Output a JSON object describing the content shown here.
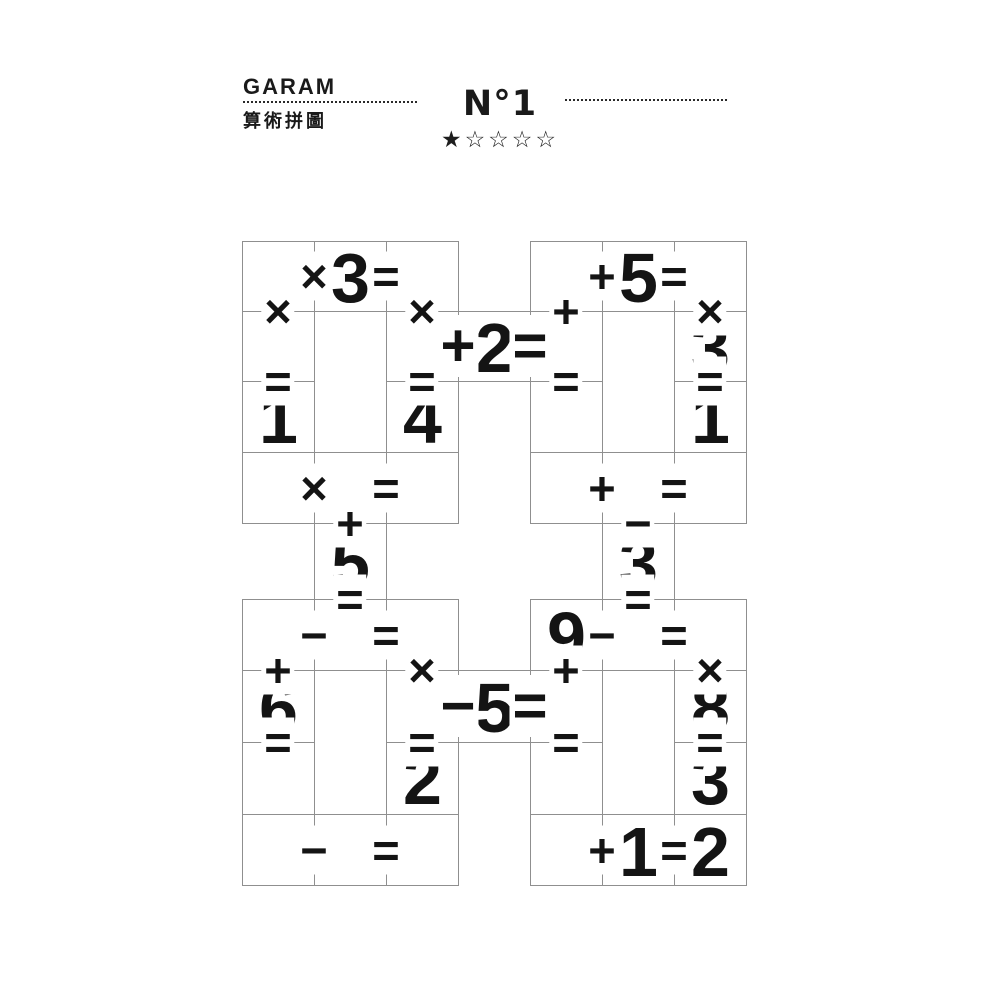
{
  "header": {
    "brand": "GARAM",
    "subtitle": "算術拼圖",
    "puzzle_number": "N°1",
    "stars": {
      "filled": "★",
      "empty": "☆☆☆☆"
    }
  },
  "colors": {
    "ink": "#161616",
    "grid_line": "#8f8f8f",
    "background": "#ffffff"
  },
  "puzzle": {
    "cols_x": [
      242,
      314,
      386,
      458,
      530,
      602,
      674,
      746
    ],
    "rows_y": [
      241,
      311,
      381,
      452,
      523,
      599,
      670,
      742,
      814,
      885
    ],
    "cells": [
      {
        "r": 0,
        "c": 0,
        "v": ""
      },
      {
        "r": 0,
        "c": 1,
        "v": "3"
      },
      {
        "r": 0,
        "c": 2,
        "v": ""
      },
      {
        "r": 1,
        "c": 0,
        "v": ""
      },
      {
        "r": 1,
        "c": 1,
        "rs": 2,
        "v": ""
      },
      {
        "r": 1,
        "c": 2,
        "v": ""
      },
      {
        "r": 2,
        "c": 0,
        "v": "1"
      },
      {
        "r": 2,
        "c": 2,
        "v": "4"
      },
      {
        "r": 3,
        "c": 0,
        "v": ""
      },
      {
        "r": 3,
        "c": 1,
        "v": ""
      },
      {
        "r": 3,
        "c": 2,
        "v": ""
      },
      {
        "r": 0,
        "c": 4,
        "v": ""
      },
      {
        "r": 0,
        "c": 5,
        "v": "5"
      },
      {
        "r": 0,
        "c": 6,
        "v": ""
      },
      {
        "r": 1,
        "c": 4,
        "v": ""
      },
      {
        "r": 1,
        "c": 5,
        "rs": 2,
        "v": ""
      },
      {
        "r": 1,
        "c": 6,
        "v": "3"
      },
      {
        "r": 2,
        "c": 4,
        "v": ""
      },
      {
        "r": 2,
        "c": 6,
        "v": "1"
      },
      {
        "r": 3,
        "c": 4,
        "v": ""
      },
      {
        "r": 3,
        "c": 5,
        "v": ""
      },
      {
        "r": 3,
        "c": 6,
        "v": ""
      },
      {
        "r": 1,
        "c": 3,
        "v": "2"
      },
      {
        "r": 4,
        "c": 1,
        "v": "5"
      },
      {
        "r": 4,
        "c": 5,
        "v": "3"
      },
      {
        "r": 6,
        "c": 3,
        "v": "5"
      },
      {
        "r": 5,
        "c": 0,
        "v": ""
      },
      {
        "r": 5,
        "c": 1,
        "v": ""
      },
      {
        "r": 5,
        "c": 2,
        "v": ""
      },
      {
        "r": 6,
        "c": 0,
        "v": "6"
      },
      {
        "r": 6,
        "c": 1,
        "rs": 2,
        "v": ""
      },
      {
        "r": 6,
        "c": 2,
        "v": ""
      },
      {
        "r": 7,
        "c": 0,
        "v": ""
      },
      {
        "r": 7,
        "c": 2,
        "v": "2"
      },
      {
        "r": 8,
        "c": 0,
        "v": ""
      },
      {
        "r": 8,
        "c": 1,
        "v": ""
      },
      {
        "r": 8,
        "c": 2,
        "v": ""
      },
      {
        "r": 5,
        "c": 4,
        "v": "9"
      },
      {
        "r": 5,
        "c": 5,
        "v": ""
      },
      {
        "r": 5,
        "c": 6,
        "v": ""
      },
      {
        "r": 6,
        "c": 4,
        "v": ""
      },
      {
        "r": 6,
        "c": 5,
        "rs": 2,
        "v": ""
      },
      {
        "r": 6,
        "c": 6,
        "v": "8"
      },
      {
        "r": 7,
        "c": 4,
        "v": ""
      },
      {
        "r": 7,
        "c": 6,
        "v": "3"
      },
      {
        "r": 8,
        "c": 4,
        "v": ""
      },
      {
        "r": 8,
        "c": 5,
        "v": "1"
      },
      {
        "r": 8,
        "c": 6,
        "v": "2"
      }
    ],
    "operators": [
      {
        "g": "×",
        "x": 1,
        "y": 0.5
      },
      {
        "g": "=",
        "x": 2,
        "y": 0.5
      },
      {
        "g": "×",
        "x": 0.5,
        "y": 1
      },
      {
        "g": "×",
        "x": 2.5,
        "y": 1
      },
      {
        "g": "=",
        "x": 0.5,
        "y": 2
      },
      {
        "g": "=",
        "x": 2.5,
        "y": 2
      },
      {
        "g": "×",
        "x": 1,
        "y": 3.5
      },
      {
        "g": "=",
        "x": 2,
        "y": 3.5
      },
      {
        "g": "+",
        "x": 5,
        "y": 0.5
      },
      {
        "g": "=",
        "x": 6,
        "y": 0.5
      },
      {
        "g": "+",
        "x": 4.5,
        "y": 1
      },
      {
        "g": "×",
        "x": 6.5,
        "y": 1
      },
      {
        "g": "=",
        "x": 4.5,
        "y": 2
      },
      {
        "g": "=",
        "x": 6.5,
        "y": 2
      },
      {
        "g": "+",
        "x": 5,
        "y": 3.5
      },
      {
        "g": "=",
        "x": 6,
        "y": 3.5
      },
      {
        "g": "+",
        "x": 3,
        "y": 1.5,
        "s": "l"
      },
      {
        "g": "=",
        "x": 4,
        "y": 1.5,
        "s": "l"
      },
      {
        "g": "−",
        "x": 3,
        "y": 6.5,
        "s": "l"
      },
      {
        "g": "=",
        "x": 4,
        "y": 6.5,
        "s": "l"
      },
      {
        "g": "+",
        "x": 1.5,
        "y": 4
      },
      {
        "g": "=",
        "x": 1.5,
        "y": 5
      },
      {
        "g": "−",
        "x": 5.5,
        "y": 4
      },
      {
        "g": "=",
        "x": 5.5,
        "y": 5
      },
      {
        "g": "−",
        "x": 1,
        "y": 5.5
      },
      {
        "g": "=",
        "x": 2,
        "y": 5.5
      },
      {
        "g": "+",
        "x": 0.5,
        "y": 6
      },
      {
        "g": "×",
        "x": 2.5,
        "y": 6
      },
      {
        "g": "=",
        "x": 0.5,
        "y": 7
      },
      {
        "g": "=",
        "x": 2.5,
        "y": 7
      },
      {
        "g": "−",
        "x": 1,
        "y": 8.5
      },
      {
        "g": "=",
        "x": 2,
        "y": 8.5
      },
      {
        "g": "−",
        "x": 5,
        "y": 5.5
      },
      {
        "g": "=",
        "x": 6,
        "y": 5.5
      },
      {
        "g": "+",
        "x": 4.5,
        "y": 6
      },
      {
        "g": "×",
        "x": 6.5,
        "y": 6
      },
      {
        "g": "=",
        "x": 4.5,
        "y": 7
      },
      {
        "g": "=",
        "x": 6.5,
        "y": 7
      },
      {
        "g": "+",
        "x": 5,
        "y": 8.5
      },
      {
        "g": "=",
        "x": 6,
        "y": 8.5
      }
    ]
  }
}
